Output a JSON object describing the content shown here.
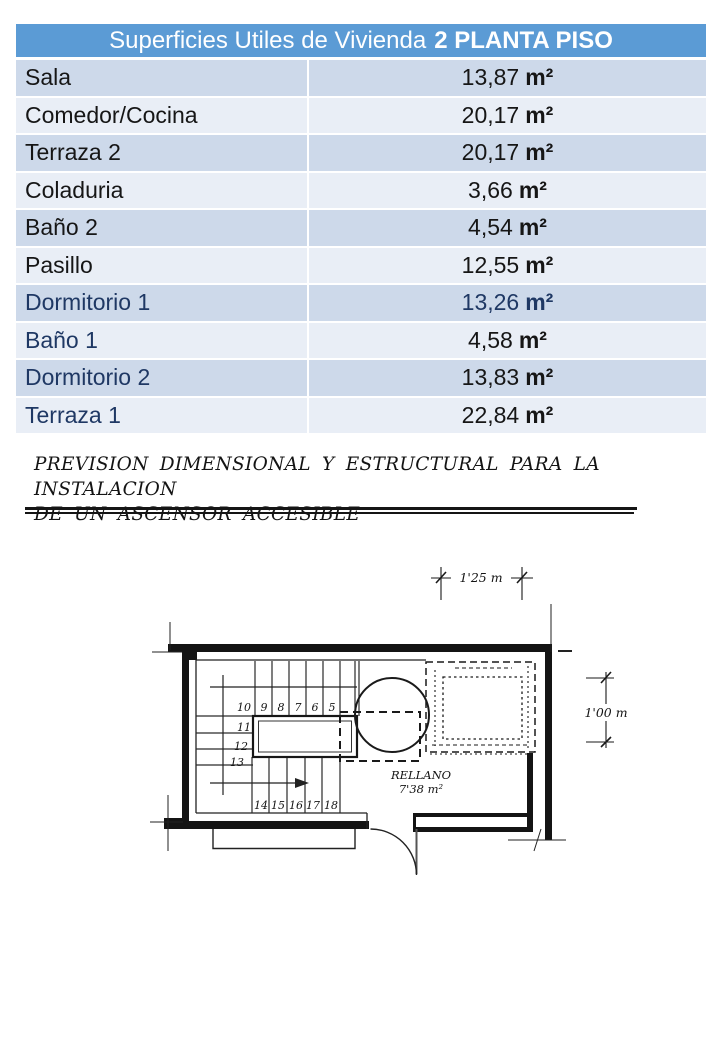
{
  "colors": {
    "accent": "#5b9bd5",
    "band-dark": "#cdd9ea",
    "band-light": "#e9eef6",
    "navy": "#1f3864",
    "ink": "#161616"
  },
  "table": {
    "title_regular": "Superficies Utiles de Vivienda",
    "title_bold": "2 PLANTA PISO",
    "rows": [
      {
        "label": "Sala",
        "value": "13,87",
        "unit": "m²"
      },
      {
        "label": "Comedor/Cocina",
        "value": "20,17",
        "unit": "m²"
      },
      {
        "label": "Terraza 2",
        "value": "20,17",
        "unit": "m²"
      },
      {
        "label": "Coladuria",
        "value": "3,66",
        "unit": "m²"
      },
      {
        "label": "Baño 2",
        "value": "4,54",
        "unit": "m²"
      },
      {
        "label": "Pasillo",
        "value": "12,55",
        "unit": "m²"
      },
      {
        "label": "Dormitorio 1",
        "value": "13,26",
        "unit": "m²"
      },
      {
        "label": "Baño 1",
        "value": "4,58",
        "unit": "m²"
      },
      {
        "label": "Dormitorio 2",
        "value": "13,83",
        "unit": "m²"
      },
      {
        "label": "Terraza 1",
        "value": "22,84",
        "unit": "m²"
      }
    ]
  },
  "heading": {
    "line1": "PREVISION DIMENSIONAL Y ESTRUCTURAL PARA LA INSTALACION",
    "line2": "DE UN ASCENSOR ACCESIBLE"
  },
  "plan": {
    "dim_top": "1'25 m",
    "dim_right": "1'00 m",
    "room_label": "RELLANO",
    "room_area": "7'38 m²",
    "steps_top": [
      "10",
      "9",
      "8",
      "7",
      "6",
      "5"
    ],
    "steps_left": [
      "11",
      "12",
      "13"
    ],
    "steps_bottom": [
      "14",
      "15",
      "16",
      "17",
      "18"
    ]
  }
}
